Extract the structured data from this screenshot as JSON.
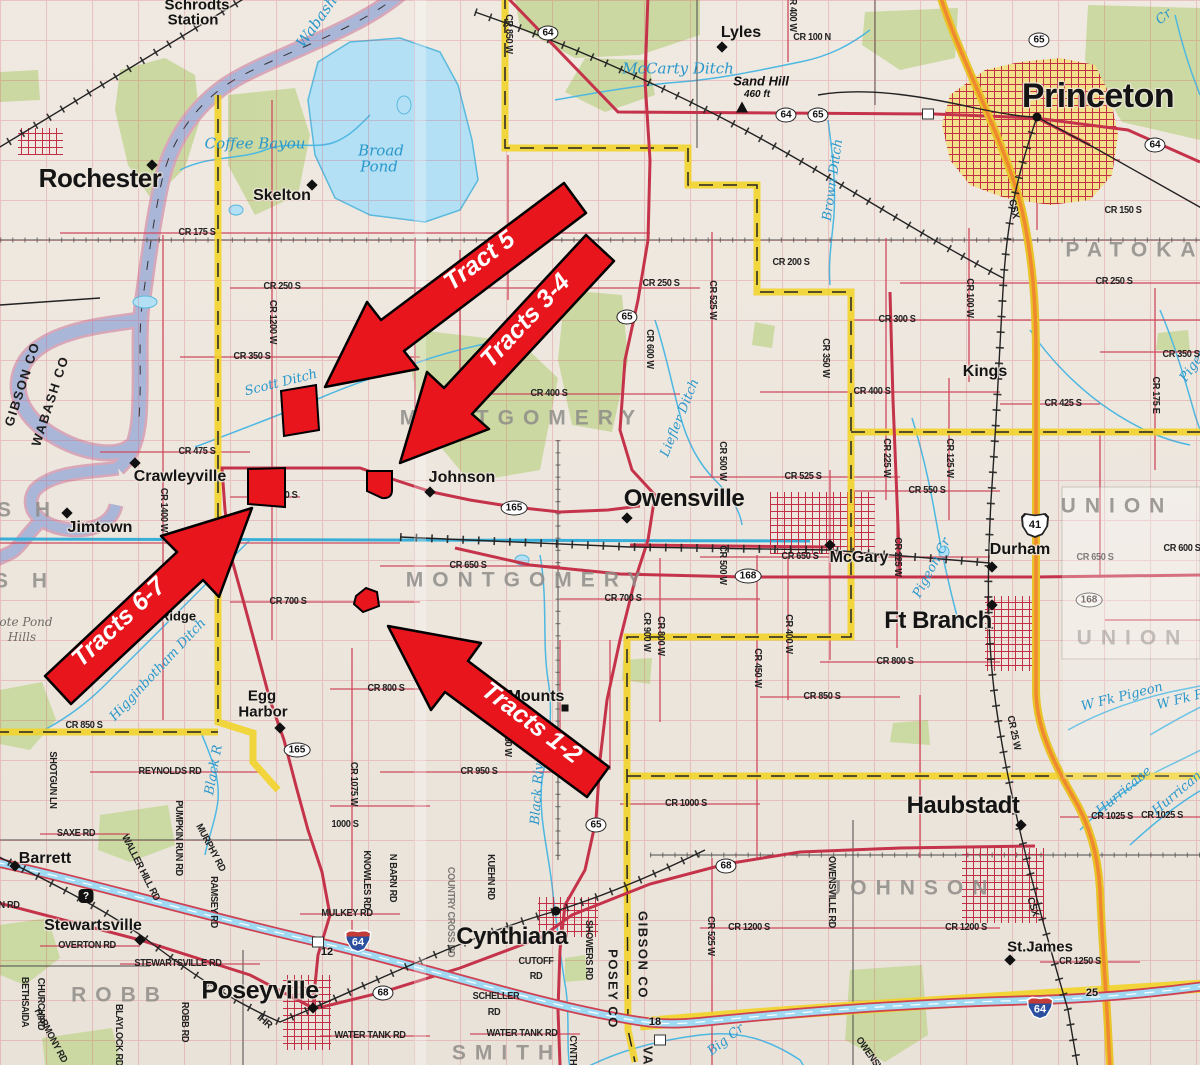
{
  "map_title": "Gibson / Posey County tract location map",
  "arrows": [
    {
      "label": "Tract 5"
    },
    {
      "label": "Tracts 3-4"
    },
    {
      "label": "Tracts 6-7"
    },
    {
      "label": "Tracts 1-2"
    }
  ],
  "colors": {
    "tract_red": "#e8151d",
    "road_red": "#c5334a",
    "county_yellow": "#f2d327",
    "water_blue": "#5bb9dd",
    "forest_green": "#c8d79b",
    "urban_yellow": "#f2e08a"
  },
  "labels": [
    {
      "t": "Rochester",
      "x": 100,
      "y": 178,
      "c": "t1"
    },
    {
      "t": "Princeton",
      "x": 1098,
      "y": 96,
      "c": "t1",
      "fs": 34
    },
    {
      "t": "Owensville",
      "x": 684,
      "y": 499,
      "c": "t1",
      "fs": 24
    },
    {
      "t": "Poseyville",
      "x": 260,
      "y": 991,
      "c": "t1",
      "fs": 25
    },
    {
      "t": "Cynthiana",
      "x": 512,
      "y": 937,
      "c": "t1",
      "fs": 24
    },
    {
      "t": "Ft Branch",
      "x": 938,
      "y": 621,
      "c": "t1",
      "fs": 24
    },
    {
      "t": "Haubstadt",
      "x": 963,
      "y": 806,
      "c": "t1",
      "fs": 24
    },
    {
      "t": "Skelton",
      "x": 282,
      "y": 196,
      "c": "t2"
    },
    {
      "t": "Lyles",
      "x": 741,
      "y": 33,
      "c": "t2"
    },
    {
      "t": "Kings",
      "x": 985,
      "y": 372,
      "c": "t2"
    },
    {
      "t": "Crawleyville",
      "x": 180,
      "y": 477,
      "c": "t2"
    },
    {
      "t": "Jimtown",
      "x": 100,
      "y": 528,
      "c": "t2"
    },
    {
      "t": "Johnson",
      "x": 462,
      "y": 478,
      "c": "t2"
    },
    {
      "t": "McGary",
      "x": 859,
      "y": 558,
      "c": "t2"
    },
    {
      "t": "Durham",
      "x": 1020,
      "y": 550,
      "c": "t2"
    },
    {
      "t": "Mounts",
      "x": 536,
      "y": 697,
      "c": "t2"
    },
    {
      "t": "St.James",
      "x": 1040,
      "y": 947,
      "c": "t2",
      "fs": 15
    },
    {
      "t": "Stewartsville",
      "x": 93,
      "y": 926,
      "c": "t2"
    },
    {
      "t": "Barrett",
      "x": 45,
      "y": 859,
      "c": "t2"
    },
    {
      "t": "Egg",
      "x": 262,
      "y": 696,
      "c": "t2",
      "fs": 15
    },
    {
      "t": "Harbor",
      "x": 263,
      "y": 712,
      "c": "t2",
      "fs": 15
    },
    {
      "t": "Schrodts",
      "x": 197,
      "y": 5,
      "c": "t2",
      "fs": 15
    },
    {
      "t": "Station",
      "x": 193,
      "y": 20,
      "c": "t2",
      "fs": 15
    },
    {
      "t": "ry",
      "x": 166,
      "y": 600,
      "c": "t3"
    },
    {
      "t": "Ridge",
      "x": 178,
      "y": 616,
      "c": "t3"
    },
    {
      "t": "Sand Hill",
      "x": 761,
      "y": 81,
      "c": "pk"
    },
    {
      "t": "460 ft",
      "x": 757,
      "y": 95,
      "c": "pk",
      "fs": 10
    },
    {
      "t": "PATOKA",
      "x": 1135,
      "y": 250,
      "c": "tw"
    },
    {
      "t": "MONTGOMERY",
      "x": 522,
      "y": 418,
      "c": "tw"
    },
    {
      "t": "MONTGOMERY",
      "x": 528,
      "y": 580,
      "c": "tw"
    },
    {
      "t": "UNION",
      "x": 1117,
      "y": 506,
      "c": "tw"
    },
    {
      "t": "UNION",
      "x": 1133,
      "y": 638,
      "c": "tw",
      "o": 0.5
    },
    {
      "t": "JOHNSON",
      "x": 913,
      "y": 888,
      "c": "tw"
    },
    {
      "t": "ROBB",
      "x": 120,
      "y": 995,
      "c": "tw"
    },
    {
      "t": "SMITH",
      "x": 507,
      "y": 1053,
      "c": "tw"
    },
    {
      "t": "S H",
      "x": 28,
      "y": 510,
      "c": "tw"
    },
    {
      "t": "S H",
      "x": 25,
      "y": 581,
      "c": "tw"
    },
    {
      "t": "GIBSON CO",
      "x": 22,
      "y": 384,
      "r": -72,
      "c": "cn"
    },
    {
      "t": "WABASH CO",
      "x": 50,
      "y": 401,
      "r": -72,
      "c": "cn"
    },
    {
      "t": "GIBSON CO",
      "x": 643,
      "y": 955,
      "r": 90,
      "c": "cn"
    },
    {
      "t": "POSEY CO",
      "x": 613,
      "y": 989,
      "r": 90,
      "c": "cn"
    },
    {
      "t": "VA",
      "x": 648,
      "y": 1056,
      "r": 90,
      "c": "cn"
    },
    {
      "t": "Wabash",
      "x": 317,
      "y": 22,
      "r": -55,
      "c": "w2"
    },
    {
      "t": "Coffee Bayou",
      "x": 255,
      "y": 144,
      "c": "w2"
    },
    {
      "t": "Broad",
      "x": 381,
      "y": 151,
      "c": "w2"
    },
    {
      "t": "Pond",
      "x": 379,
      "y": 167,
      "c": "w2"
    },
    {
      "t": "McCarty Ditch",
      "x": 678,
      "y": 69,
      "c": "w2"
    },
    {
      "t": "Scott Ditch",
      "x": 281,
      "y": 383,
      "r": -14,
      "c": "w"
    },
    {
      "t": "Liefler Ditch",
      "x": 680,
      "y": 418,
      "r": -68,
      "c": "w"
    },
    {
      "t": "Higginbotham Ditch",
      "x": 158,
      "y": 670,
      "r": -47,
      "c": "w"
    },
    {
      "t": "Black R",
      "x": 214,
      "y": 770,
      "r": -80,
      "c": "w"
    },
    {
      "t": "Black River",
      "x": 538,
      "y": 787,
      "r": -86,
      "c": "w"
    },
    {
      "t": "Brown Ditch",
      "x": 833,
      "y": 180,
      "r": -82,
      "c": "w"
    },
    {
      "t": "Pigeon Cr",
      "x": 932,
      "y": 568,
      "r": -62,
      "c": "w"
    },
    {
      "t": "Pigeon",
      "x": 1196,
      "y": 362,
      "r": -55,
      "c": "w"
    },
    {
      "t": "W Fk Pigeon",
      "x": 1122,
      "y": 697,
      "r": -14,
      "c": "w"
    },
    {
      "t": "W Fk P",
      "x": 1180,
      "y": 700,
      "r": -14,
      "c": "w"
    },
    {
      "t": "Hurricane",
      "x": 1124,
      "y": 791,
      "r": -40,
      "c": "w"
    },
    {
      "t": "Hurricane",
      "x": 1180,
      "y": 791,
      "r": -40,
      "c": "w"
    },
    {
      "t": "Big Cr",
      "x": 726,
      "y": 1040,
      "r": -38,
      "c": "w"
    },
    {
      "t": "Cr",
      "x": 1164,
      "y": 17,
      "r": -40,
      "c": "w"
    },
    {
      "t": "ote Pond",
      "x": 26,
      "y": 622,
      "c": "tr"
    },
    {
      "t": "Hills",
      "x": 22,
      "y": 637,
      "c": "tr"
    },
    {
      "t": "CR 175 S",
      "x": 197,
      "y": 233,
      "c": "rd"
    },
    {
      "t": "CR 250 S",
      "x": 282,
      "y": 287,
      "c": "rd"
    },
    {
      "t": "CR 1200 W",
      "x": 272,
      "y": 322,
      "r": 90,
      "c": "rd"
    },
    {
      "t": "CR 350 S",
      "x": 252,
      "y": 357,
      "c": "rd"
    },
    {
      "t": "CR 475 S",
      "x": 197,
      "y": 452,
      "c": "rd"
    },
    {
      "t": "CR 1400 W",
      "x": 163,
      "y": 510,
      "r": 90,
      "c": "rd"
    },
    {
      "t": "CR 250 S",
      "x": 661,
      "y": 284,
      "c": "rd"
    },
    {
      "t": "CR 600 W",
      "x": 649,
      "y": 349,
      "r": 90,
      "c": "rd"
    },
    {
      "t": "CR 400 S",
      "x": 549,
      "y": 394,
      "c": "rd"
    },
    {
      "t": "CR 200 S",
      "x": 791,
      "y": 263,
      "c": "rd"
    },
    {
      "t": "CR 525 W",
      "x": 712,
      "y": 300,
      "r": 90,
      "c": "rd"
    },
    {
      "t": "CR 350 W",
      "x": 825,
      "y": 358,
      "r": 90,
      "c": "rd"
    },
    {
      "t": "CR 300 S",
      "x": 897,
      "y": 320,
      "c": "rd"
    },
    {
      "t": "CR 400 S",
      "x": 872,
      "y": 392,
      "c": "rd"
    },
    {
      "t": "CR 225 W",
      "x": 886,
      "y": 458,
      "r": 90,
      "c": "rd"
    },
    {
      "t": "CR 525 S",
      "x": 803,
      "y": 477,
      "c": "rd"
    },
    {
      "t": "CR 500 W",
      "x": 722,
      "y": 461,
      "r": 90,
      "c": "rd"
    },
    {
      "t": "CR 100 N",
      "x": 812,
      "y": 38,
      "c": "rd"
    },
    {
      "t": "CR 850 W",
      "x": 508,
      "y": 34,
      "r": 90,
      "c": "rd"
    },
    {
      "t": "CR 400 W",
      "x": 792,
      "y": 12,
      "r": 90,
      "c": "rd"
    },
    {
      "t": "CR 100 W",
      "x": 969,
      "y": 298,
      "r": 90,
      "c": "rd"
    },
    {
      "t": "CR 250 S",
      "x": 1114,
      "y": 282,
      "c": "rd"
    },
    {
      "t": "CR 150 S",
      "x": 1123,
      "y": 211,
      "c": "rd"
    },
    {
      "t": "CR 350 S",
      "x": 1181,
      "y": 355,
      "c": "rd"
    },
    {
      "t": "CR 175 E",
      "x": 1155,
      "y": 395,
      "r": 90,
      "c": "rd"
    },
    {
      "t": "CR 425 S",
      "x": 1063,
      "y": 404,
      "c": "rd"
    },
    {
      "t": "CR 125 W",
      "x": 949,
      "y": 458,
      "r": 90,
      "c": "rd"
    },
    {
      "t": "CR 550 S",
      "x": 927,
      "y": 491,
      "c": "rd"
    },
    {
      "t": "CR 650 S",
      "x": 468,
      "y": 566,
      "c": "rd"
    },
    {
      "t": "CR 650 S",
      "x": 800,
      "y": 557,
      "c": "rd"
    },
    {
      "t": "CR 225 W",
      "x": 897,
      "y": 557,
      "r": 90,
      "c": "rd"
    },
    {
      "t": "CR 500 W",
      "x": 722,
      "y": 565,
      "r": 90,
      "c": "rd"
    },
    {
      "t": "CR 700 S",
      "x": 288,
      "y": 602,
      "c": "rd"
    },
    {
      "t": "CR 700 S",
      "x": 623,
      "y": 599,
      "c": "rd"
    },
    {
      "t": "CR 800 S",
      "x": 895,
      "y": 662,
      "c": "rd"
    },
    {
      "t": "CR 850 S",
      "x": 822,
      "y": 697,
      "c": "rd"
    },
    {
      "t": "CR 400 W",
      "x": 788,
      "y": 634,
      "r": 90,
      "c": "rd"
    },
    {
      "t": "CR 800 W",
      "x": 660,
      "y": 636,
      "r": 90,
      "c": "rd"
    },
    {
      "t": "CR 450 W",
      "x": 757,
      "y": 668,
      "r": 90,
      "c": "rd"
    },
    {
      "t": "CR 900 W",
      "x": 646,
      "y": 632,
      "r": 90,
      "c": "rd"
    },
    {
      "t": "CR 850 S",
      "x": 84,
      "y": 726,
      "c": "rd"
    },
    {
      "t": "CR 800 S",
      "x": 386,
      "y": 689,
      "c": "rd"
    },
    {
      "t": "CR 850 W",
      "x": 507,
      "y": 737,
      "r": 90,
      "c": "rd"
    },
    {
      "t": "CR 950 S",
      "x": 479,
      "y": 772,
      "c": "rd"
    },
    {
      "t": "CR 1075 W",
      "x": 353,
      "y": 784,
      "r": 90,
      "c": "rd"
    },
    {
      "t": "1000 S",
      "x": 345,
      "y": 825,
      "c": "rd"
    },
    {
      "t": "CR 1000 S",
      "x": 686,
      "y": 804,
      "c": "rd"
    },
    {
      "t": "CR 1025 S",
      "x": 1112,
      "y": 817,
      "c": "rd"
    },
    {
      "t": "CR 1025 S",
      "x": 1162,
      "y": 816,
      "c": "rd"
    },
    {
      "t": "CR 1200 S",
      "x": 749,
      "y": 928,
      "c": "rd"
    },
    {
      "t": "CR 1200 S",
      "x": 966,
      "y": 928,
      "c": "rd"
    },
    {
      "t": "CR 1250 S",
      "x": 1080,
      "y": 962,
      "c": "rd"
    },
    {
      "t": "CR 600 S",
      "x": 1182,
      "y": 549,
      "c": "rd"
    },
    {
      "t": "CR 650 S",
      "x": 1095,
      "y": 558,
      "c": "rf"
    },
    {
      "t": "CR 25 W",
      "x": 1013,
      "y": 733,
      "r": 78,
      "c": "rd"
    },
    {
      "t": "CR 525 W",
      "x": 710,
      "y": 936,
      "r": 90,
      "c": "rd"
    },
    {
      "t": "OWENSVILLE RD",
      "x": 831,
      "y": 892,
      "r": 90,
      "c": "rd"
    },
    {
      "t": "SHOWERS RD",
      "x": 588,
      "y": 950,
      "r": 90,
      "c": "rd"
    },
    {
      "t": "KUEHN RD",
      "x": 490,
      "y": 877,
      "r": 90,
      "c": "rd"
    },
    {
      "t": "CUTOFF",
      "x": 536,
      "y": 962,
      "c": "rd"
    },
    {
      "t": "RD",
      "x": 536,
      "y": 977,
      "c": "rd"
    },
    {
      "t": "SCHELLER",
      "x": 496,
      "y": 997,
      "c": "rd"
    },
    {
      "t": "RD",
      "x": 494,
      "y": 1013,
      "c": "rd"
    },
    {
      "t": "WATER TANK RD",
      "x": 370,
      "y": 1036,
      "c": "rd"
    },
    {
      "t": "WATER TANK RD",
      "x": 522,
      "y": 1034,
      "c": "rd"
    },
    {
      "t": "REYNOLDS RD",
      "x": 170,
      "y": 772,
      "c": "rd"
    },
    {
      "t": "SAXE RD",
      "x": 76,
      "y": 834,
      "c": "rd"
    },
    {
      "t": "SHOTGUN LN",
      "x": 52,
      "y": 780,
      "r": 90,
      "c": "rd"
    },
    {
      "t": "PUMPKIN RUN RD",
      "x": 178,
      "y": 838,
      "r": 90,
      "c": "rd"
    },
    {
      "t": "MURPHY RD",
      "x": 210,
      "y": 848,
      "r": 62,
      "c": "rd"
    },
    {
      "t": "RAMSEY RD",
      "x": 213,
      "y": 902,
      "r": 90,
      "c": "rd"
    },
    {
      "t": "WALLER HILL RD",
      "x": 140,
      "y": 868,
      "r": 63,
      "c": "rd"
    },
    {
      "t": "OVERTON RD",
      "x": 87,
      "y": 946,
      "c": "rd"
    },
    {
      "t": "STEWARTSVILLE RD",
      "x": 178,
      "y": 964,
      "c": "rd"
    },
    {
      "t": "ROBB RD",
      "x": 184,
      "y": 1022,
      "r": 90,
      "c": "rd"
    },
    {
      "t": "BLAYLOCK RD",
      "x": 118,
      "y": 1035,
      "r": 90,
      "c": "rd"
    },
    {
      "t": "BETHSAIDA",
      "x": 24,
      "y": 1002,
      "r": 90,
      "c": "rd"
    },
    {
      "t": "CHURCH RD",
      "x": 40,
      "y": 1004,
      "r": 90,
      "c": "rd"
    },
    {
      "t": "HARMONY RD",
      "x": 50,
      "y": 1036,
      "r": 62,
      "c": "rd"
    },
    {
      "t": "MULKEY RD",
      "x": 347,
      "y": 914,
      "c": "rd"
    },
    {
      "t": "N BARN RD",
      "x": 392,
      "y": 878,
      "r": 90,
      "c": "rd"
    },
    {
      "t": "KNOWLES RD",
      "x": 366,
      "y": 880,
      "r": 90,
      "c": "rd"
    },
    {
      "t": "CYNTHIANA RD",
      "x": 572,
      "y": 1068,
      "r": 90,
      "c": "rd"
    },
    {
      "t": "OWENSVILLE RD",
      "x": 878,
      "y": 1068,
      "r": 55,
      "c": "rd"
    },
    {
      "t": "N RD",
      "x": 9,
      "y": 906,
      "c": "rd"
    },
    {
      "t": "0 S",
      "x": 291,
      "y": 496,
      "c": "rd"
    },
    {
      "t": "COUNTRY CROSS RD",
      "x": 450,
      "y": 912,
      "r": 90,
      "c": "rf"
    }
  ],
  "shields": [
    {
      "t": "oval",
      "n": "64",
      "x": 548,
      "y": 33
    },
    {
      "t": "oval",
      "n": "64",
      "x": 786,
      "y": 115
    },
    {
      "t": "oval",
      "n": "65",
      "x": 818,
      "y": 115
    },
    {
      "t": "oval",
      "n": "65",
      "x": 1039,
      "y": 40
    },
    {
      "t": "oval",
      "n": "64",
      "x": 1155,
      "y": 145
    },
    {
      "t": "oval",
      "n": "65",
      "x": 627,
      "y": 317
    },
    {
      "t": "oval",
      "n": "65",
      "x": 596,
      "y": 825
    },
    {
      "t": "oval",
      "n": "165",
      "x": 514,
      "y": 508
    },
    {
      "t": "oval",
      "n": "165",
      "x": 297,
      "y": 750
    },
    {
      "t": "oval",
      "n": "168",
      "x": 748,
      "y": 576
    },
    {
      "t": "oval",
      "n": "168",
      "x": 1089,
      "y": 600,
      "o": 0.55
    },
    {
      "t": "oval",
      "n": "68",
      "x": 383,
      "y": 993
    },
    {
      "t": "oval",
      "n": "68",
      "x": 726,
      "y": 866
    },
    {
      "t": "us",
      "n": "41",
      "x": 1035,
      "y": 525
    },
    {
      "t": "int",
      "n": "64",
      "x": 358,
      "y": 941
    },
    {
      "t": "int",
      "n": "64",
      "x": 1040,
      "y": 1008
    }
  ],
  "exits": [
    {
      "n": "12",
      "x": 327,
      "y": 952
    },
    {
      "n": "18",
      "x": 655,
      "y": 1022
    },
    {
      "n": "25",
      "x": 1092,
      "y": 993
    }
  ],
  "markers": [
    {
      "k": "diamond",
      "x": 152,
      "y": 165
    },
    {
      "k": "diamond",
      "x": 312,
      "y": 185
    },
    {
      "k": "diamond",
      "x": 722,
      "y": 47
    },
    {
      "k": "diamond",
      "x": 135,
      "y": 463
    },
    {
      "k": "diamond",
      "x": 67,
      "y": 513
    },
    {
      "k": "diamond",
      "x": 430,
      "y": 492
    },
    {
      "k": "diamond",
      "x": 627,
      "y": 518
    },
    {
      "k": "diamond",
      "x": 830,
      "y": 545
    },
    {
      "k": "diamond",
      "x": 992,
      "y": 567
    },
    {
      "k": "diamond",
      "x": 992,
      "y": 605
    },
    {
      "k": "diamond",
      "x": 280,
      "y": 728
    },
    {
      "k": "diamond",
      "x": 1021,
      "y": 825
    },
    {
      "k": "diamond",
      "x": 1010,
      "y": 960
    },
    {
      "k": "diamond",
      "x": 313,
      "y": 1008
    },
    {
      "k": "diamond",
      "x": 140,
      "y": 940
    },
    {
      "k": "diamond",
      "x": 15,
      "y": 866
    },
    {
      "k": "dot",
      "x": 1037,
      "y": 117
    },
    {
      "k": "dot",
      "x": 556,
      "y": 911
    },
    {
      "k": "sq",
      "x": 565,
      "y": 708
    },
    {
      "k": "tri",
      "x": 742,
      "y": 107
    },
    {
      "k": "q",
      "x": 86,
      "y": 896
    },
    {
      "k": "box",
      "x": 318,
      "y": 942
    },
    {
      "k": "box",
      "x": 928,
      "y": 114
    },
    {
      "k": "box",
      "x": 660,
      "y": 1040
    }
  ],
  "rail_labels": [
    {
      "t": "CSX",
      "x": 1013,
      "y": 209,
      "r": 78
    },
    {
      "t": "CSX",
      "x": 1032,
      "y": 907,
      "r": 72
    },
    {
      "t": "IHR",
      "x": 264,
      "y": 1022,
      "r": 40
    }
  ]
}
